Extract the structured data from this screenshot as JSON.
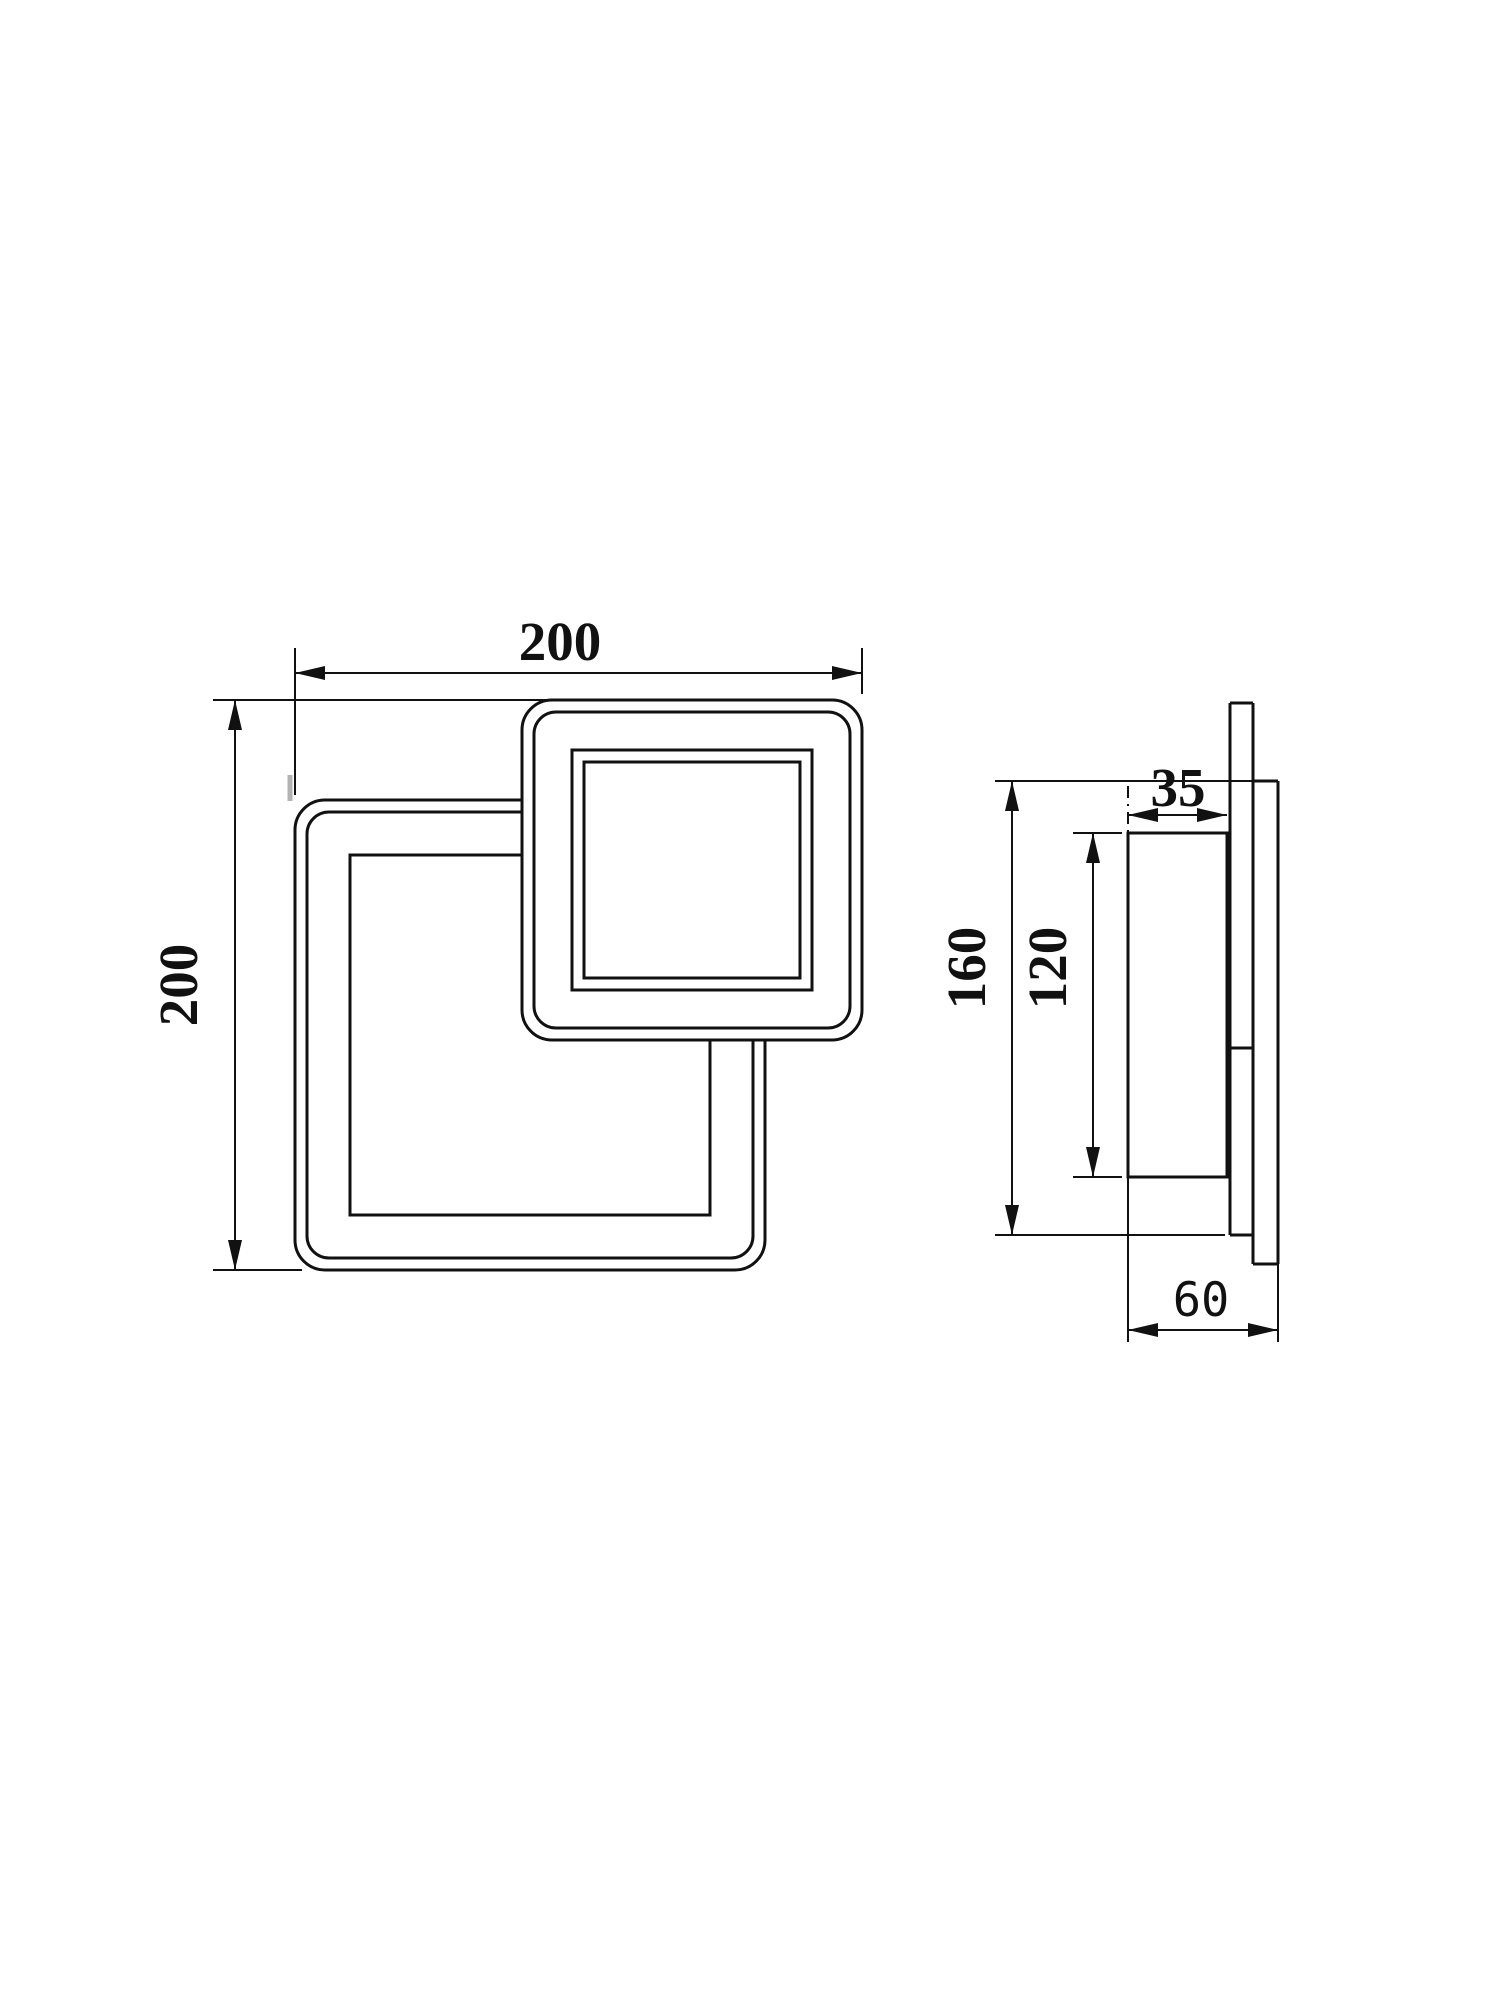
{
  "drawing": {
    "background_color": "#ffffff",
    "line_color": "#111111",
    "views": {
      "front_view": {
        "description": "front view with two overlapping rounded squares",
        "width_label": "200",
        "height_label": "200"
      },
      "side_view": {
        "description": "side profile with wall plate",
        "body_depth_label": "35",
        "overall_height_label": "160",
        "body_height_label": "120",
        "total_depth_label": "60"
      }
    }
  }
}
